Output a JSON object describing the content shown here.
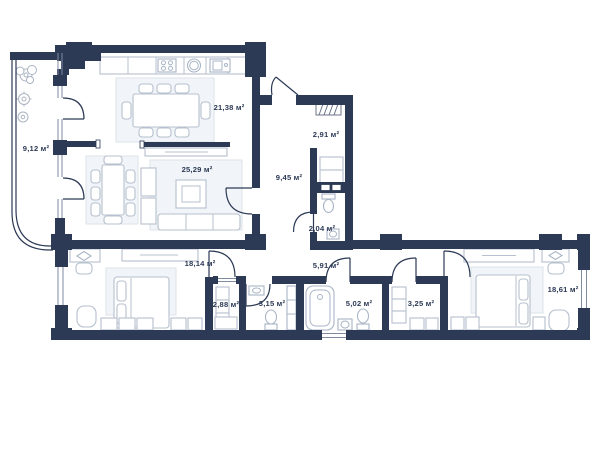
{
  "plan": {
    "kind": "apartment-floor-plan",
    "unit_symbol": "м²",
    "colors": {
      "wall": "#2c3a55",
      "furniture": "#b6c0ce",
      "rug": "#f1f4f8",
      "text": "#2c3a55"
    },
    "rooms": [
      {
        "id": "balcony",
        "label": "9,12 м²"
      },
      {
        "id": "kitchen-dining",
        "label": "21,38 м²"
      },
      {
        "id": "living-room",
        "label": "25,29 м²"
      },
      {
        "id": "storage",
        "label": "2,91 м²"
      },
      {
        "id": "hallway",
        "label": "9,45 м²"
      },
      {
        "id": "wc",
        "label": "2,04 м²"
      },
      {
        "id": "corridor",
        "label": "5,91 м²"
      },
      {
        "id": "bedroom-left",
        "label": "18,14 м²"
      },
      {
        "id": "wardrobe-left",
        "label": "2,88 м²"
      },
      {
        "id": "bathroom-left",
        "label": "3,15 м²"
      },
      {
        "id": "bathroom-right",
        "label": "5,02 м²"
      },
      {
        "id": "wardrobe-right",
        "label": "3,25 м²"
      },
      {
        "id": "bedroom-right",
        "label": "18,61 м²"
      }
    ]
  }
}
